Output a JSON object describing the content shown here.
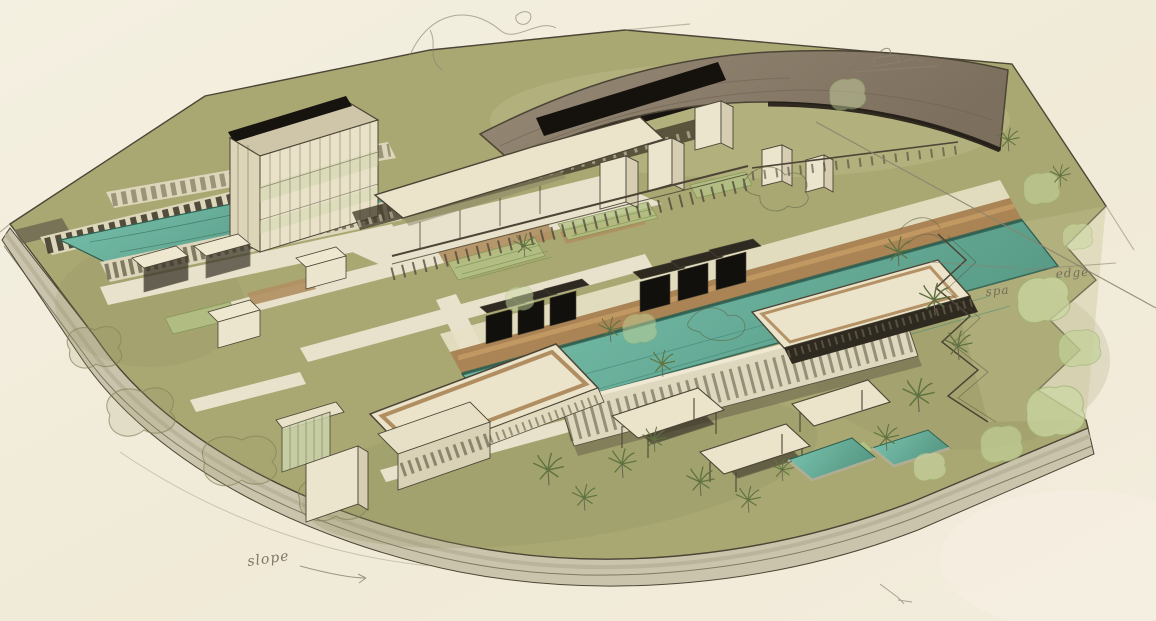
{
  "meta": {
    "type": "architectural-concept-sketch",
    "subject": "Aerial perspective sketch of a resort masterplan with courtyard buildings, lap pools, cabanas and landscaped terraces",
    "style": "hand-drawn ink and watercolor wash on cream paper"
  },
  "palette": {
    "paper": "#f1ecda",
    "paperLine": "#b9b29a",
    "lawn": "#a9a873",
    "lawnDark": "#8f9060",
    "lawnLight": "#c6c491",
    "plinth": "#cbc4ac",
    "ink": "#4c4536",
    "pencil": "#8a8270",
    "pool": "#74bda8",
    "poolDeep": "#569884",
    "poolEdge": "#2f5f50",
    "roofDark": "#17130e",
    "roofTaupe": "#8d7f6d",
    "roofTaupeDark": "#786b59",
    "roofCream": "#ebe4cb",
    "wood": "#aa8455",
    "woodLight": "#c89e66",
    "wall": "#ece5cd",
    "wallShade": "#d6cdb2",
    "glass": "#ccd4ab",
    "slatBand": "#ddd6ba",
    "treeSoft": "#ccd9a4",
    "treeLine": "#5e6648",
    "palm": "#5f7340",
    "annotation": "#6b6354"
  },
  "annotations": {
    "slope": "slope",
    "spa": "spa",
    "edge": "edge"
  },
  "features": [
    "curved entry canopy roof",
    "dark linear spine building",
    "gridded courtyard building",
    "upper lap pool with pergola rows",
    "main infinity lap pool",
    "pool deck with daybed cabanas",
    "poolside bar pavilion",
    "spa pavilion",
    "garden courtyards",
    "white guestroom towers",
    "flat-roof villa pavilions",
    "two plunge pools",
    "zigzag garden terraces",
    "palm trees and watercolor trees",
    "curved landscape plinth edge",
    "handwritten site notes",
    "thumbnail doodle",
    "long construction pencil lines"
  ]
}
